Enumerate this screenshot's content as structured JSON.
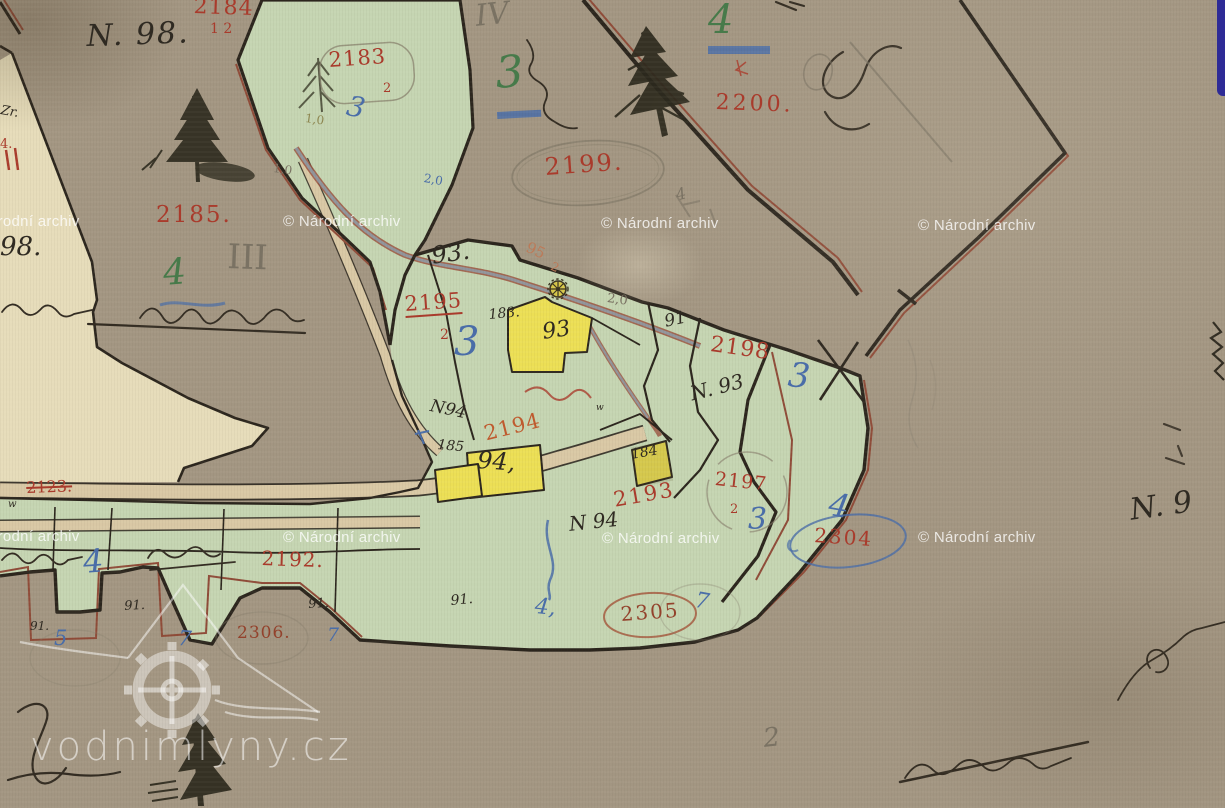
{
  "map": {
    "type": "historical-cadastral-map-scan",
    "colors": {
      "ink": "#2f2a22",
      "red": "#a93b2c",
      "orange": "#bf5a2e",
      "faded": "#bc7a58",
      "brownred": "#93422c",
      "green": "#477a4a",
      "blue": "#4a6da8",
      "pencil": "#7a7263",
      "olive": "#8d8650",
      "paper": "#a59884",
      "cream": "#e6dcba",
      "parcel_green": "#c5d5b2",
      "building_yellow": "#ecdf55",
      "road": "#d9c8a5",
      "boundary_black": "#2b251d",
      "boundary_redbrown": "#8f4b38"
    },
    "labels": [
      {
        "n": "label-n98",
        "t": "N. 98.",
        "x": 86,
        "y": 22,
        "s": 30,
        "c": "ink",
        "r": -2,
        "cls": "cur",
        "ls": 2
      },
      {
        "n": "label-98",
        "t": "98.",
        "x": 0,
        "y": 234,
        "s": 26,
        "c": "ink",
        "r": 0,
        "cls": "cur"
      },
      {
        "n": "label-zr",
        "t": "Zr.",
        "x": 2,
        "y": 104,
        "s": 13,
        "c": "ink",
        "r": 10,
        "cls": "cur"
      },
      {
        "n": "label-93-dot",
        "t": "93.",
        "x": 430,
        "y": 244,
        "s": 24,
        "c": "ink",
        "r": -8,
        "cls": "cur"
      },
      {
        "n": "label-183",
        "t": "183.",
        "x": 488,
        "y": 308,
        "s": 14,
        "c": "ink",
        "r": -5,
        "cls": "cur"
      },
      {
        "n": "label-93-house",
        "t": "93",
        "x": 541,
        "y": 322,
        "s": 22,
        "c": "ink",
        "r": -8,
        "cls": "cur"
      },
      {
        "n": "label-n94-upper",
        "t": "N94",
        "x": 432,
        "y": 398,
        "s": 17,
        "c": "ink",
        "r": 12,
        "cls": "cur"
      },
      {
        "n": "label-185",
        "t": "185",
        "x": 438,
        "y": 438,
        "s": 14,
        "c": "ink",
        "r": 5,
        "cls": "cur"
      },
      {
        "n": "label-94-house",
        "t": "94,",
        "x": 478,
        "y": 448,
        "s": 24,
        "c": "ink",
        "r": 4,
        "cls": "cur"
      },
      {
        "n": "label-184-house",
        "t": "184",
        "x": 630,
        "y": 448,
        "s": 14,
        "c": "ink",
        "r": -10,
        "cls": "cur"
      },
      {
        "n": "label-n94-lower",
        "t": "N 94",
        "x": 568,
        "y": 514,
        "s": 20,
        "c": "ink",
        "r": -6,
        "cls": "cur"
      },
      {
        "n": "label-91-upper",
        "t": "91",
        "x": 663,
        "y": 314,
        "s": 17,
        "c": "ink",
        "r": -12,
        "cls": "cur"
      },
      {
        "n": "label-n93",
        "t": "N. 93",
        "x": 688,
        "y": 384,
        "s": 20,
        "c": "ink",
        "r": -14,
        "cls": "cur"
      },
      {
        "n": "label-91-strip-a",
        "t": "91.",
        "x": 124,
        "y": 600,
        "s": 13,
        "c": "ink",
        "r": -3,
        "cls": "cur"
      },
      {
        "n": "label-91-strip-b",
        "t": "91.",
        "x": 308,
        "y": 598,
        "s": 13,
        "c": "ink",
        "r": -3,
        "cls": "cur"
      },
      {
        "n": "label-91-strip-c",
        "t": "91.",
        "x": 30,
        "y": 620,
        "s": 12,
        "c": "ink",
        "r": 0,
        "cls": "cur"
      },
      {
        "n": "label-91-strip-d",
        "t": "91.",
        "x": 450,
        "y": 594,
        "s": 14,
        "c": "ink",
        "r": -5,
        "cls": "cur"
      },
      {
        "n": "label-w-road",
        "t": "w",
        "x": 8,
        "y": 500,
        "s": 10,
        "c": "ink",
        "r": 0,
        "cls": "cur"
      },
      {
        "n": "label-w-mid",
        "t": "w",
        "x": 596,
        "y": 404,
        "s": 9,
        "c": "ink",
        "r": 0,
        "cls": "cur"
      },
      {
        "n": "label-n9-right",
        "t": "N. 9",
        "x": 1128,
        "y": 496,
        "s": 30,
        "c": "ink",
        "r": -8,
        "cls": "cur"
      },
      {
        "n": "parcel-2184",
        "t": "2184",
        "x": 194,
        "y": -4,
        "s": 22,
        "c": "red",
        "r": 2,
        "ls": 1
      },
      {
        "n": "parcel-2184-sub",
        "t": "1 2",
        "x": 210,
        "y": 22,
        "s": 14,
        "c": "red",
        "r": 0
      },
      {
        "n": "parcel-2183",
        "t": "2183",
        "x": 328,
        "y": 50,
        "s": 21,
        "c": "red",
        "r": -4,
        "ls": 1
      },
      {
        "n": "parcel-2183-sub",
        "t": "2",
        "x": 383,
        "y": 82,
        "s": 13,
        "c": "red",
        "r": 0
      },
      {
        "n": "parcel-2200",
        "t": "2200.",
        "x": 716,
        "y": 92,
        "s": 22,
        "c": "red",
        "r": 2,
        "ls": 3
      },
      {
        "n": "parcel-2199",
        "t": "2199.",
        "x": 544,
        "y": 155,
        "s": 24,
        "c": "red",
        "r": -4,
        "ls": 2
      },
      {
        "n": "parcel-2185",
        "t": "2185.",
        "x": 156,
        "y": 204,
        "s": 23,
        "c": "red",
        "r": 0,
        "ls": 2
      },
      {
        "n": "parcel-95-2",
        "t": "95",
        "x": 530,
        "y": 240,
        "s": 15,
        "c": "faded",
        "r": 25
      },
      {
        "n": "parcel-95-2-sub",
        "t": "2",
        "x": 554,
        "y": 260,
        "s": 12,
        "c": "faded",
        "r": 25
      },
      {
        "n": "parcel-2195",
        "t": "2195",
        "x": 404,
        "y": 294,
        "s": 21,
        "c": "red",
        "r": -4,
        "cls": "u",
        "ls": 1
      },
      {
        "n": "parcel-2195-sub",
        "t": "2",
        "x": 440,
        "y": 328,
        "s": 14,
        "c": "red",
        "r": 0
      },
      {
        "n": "parcel-2198",
        "t": "2198",
        "x": 712,
        "y": 334,
        "s": 22,
        "c": "red",
        "r": 8,
        "ls": 1
      },
      {
        "n": "parcel-2194",
        "t": "2194",
        "x": 482,
        "y": 424,
        "s": 21,
        "c": "orange",
        "r": -14,
        "ls": 1
      },
      {
        "n": "parcel-2193",
        "t": "2193",
        "x": 612,
        "y": 490,
        "s": 21,
        "c": "red",
        "r": -10,
        "ls": 2
      },
      {
        "n": "parcel-2197",
        "t": "2197",
        "x": 716,
        "y": 470,
        "s": 19,
        "c": "red",
        "r": 6,
        "ls": 1
      },
      {
        "n": "parcel-2197-sub",
        "t": "2",
        "x": 730,
        "y": 503,
        "s": 13,
        "c": "red",
        "r": 0
      },
      {
        "n": "parcel-2304",
        "t": "2304",
        "x": 815,
        "y": 525,
        "s": 20,
        "c": "red",
        "r": 4,
        "ls": 2
      },
      {
        "n": "parcel-2192",
        "t": "2192.",
        "x": 262,
        "y": 548,
        "s": 20,
        "c": "red",
        "r": 2,
        "ls": 1
      },
      {
        "n": "parcel-2306",
        "t": "2306.",
        "x": 237,
        "y": 625,
        "s": 17,
        "c": "brownred",
        "r": 0,
        "ls": 1
      },
      {
        "n": "parcel-2305",
        "t": "2305",
        "x": 620,
        "y": 604,
        "s": 20,
        "c": "brownred",
        "r": -4,
        "ls": 2
      },
      {
        "n": "parcel-2123",
        "t": "2123.",
        "x": 26,
        "y": 480,
        "s": 16,
        "c": "red",
        "r": -2,
        "cls": "st"
      },
      {
        "n": "mark-red-left",
        "t": "4.",
        "x": 0,
        "y": 138,
        "s": 13,
        "c": "red",
        "r": 0
      },
      {
        "n": "class-3-top",
        "t": "3",
        "x": 494,
        "y": 52,
        "s": 44,
        "c": "green",
        "r": -4,
        "cls": "cur"
      },
      {
        "n": "class-4-top",
        "t": "4",
        "x": 708,
        "y": 0,
        "s": 40,
        "c": "green",
        "r": 0,
        "cls": "cur"
      },
      {
        "n": "class-4-mid",
        "t": "4",
        "x": 162,
        "y": 256,
        "s": 36,
        "c": "green",
        "r": -4,
        "cls": "cur"
      },
      {
        "n": "class-3-band",
        "t": "3",
        "x": 350,
        "y": 92,
        "s": 28,
        "c": "blue",
        "r": 12,
        "cls": "cur"
      },
      {
        "n": "class-3-central",
        "t": "3",
        "x": 454,
        "y": 322,
        "s": 40,
        "c": "blue",
        "r": 0,
        "cls": "cur"
      },
      {
        "n": "class-3-east",
        "t": "3",
        "x": 790,
        "y": 358,
        "s": 34,
        "c": "blue",
        "r": 6,
        "cls": "cur"
      },
      {
        "n": "class-3-south",
        "t": "3",
        "x": 748,
        "y": 505,
        "s": 30,
        "c": "blue",
        "r": 0,
        "cls": "cur"
      },
      {
        "n": "class-4-east",
        "t": "4",
        "x": 832,
        "y": 488,
        "s": 32,
        "c": "blue",
        "r": 10,
        "cls": "cur"
      },
      {
        "n": "class-4-strip",
        "t": "4",
        "x": 82,
        "y": 546,
        "s": 32,
        "c": "blue",
        "r": -4,
        "cls": "cur"
      },
      {
        "n": "class-4-mid-strip",
        "t": "4,",
        "x": 536,
        "y": 596,
        "s": 22,
        "c": "blue",
        "r": 6,
        "cls": "cur"
      },
      {
        "n": "mark-5-strip",
        "t": "5",
        "x": 54,
        "y": 628,
        "s": 21,
        "c": "blue",
        "r": 0,
        "cls": "cur"
      },
      {
        "n": "mark-7-strip-a",
        "t": "7",
        "x": 179,
        "y": 628,
        "s": 21,
        "c": "blue",
        "r": 5,
        "cls": "cur"
      },
      {
        "n": "mark-7-strip-b",
        "t": "7",
        "x": 327,
        "y": 626,
        "s": 19,
        "c": "blue",
        "r": 0,
        "cls": "cur"
      },
      {
        "n": "mark-7-strip-c",
        "t": "7",
        "x": 697,
        "y": 590,
        "s": 22,
        "c": "blue",
        "r": 10,
        "cls": "cur"
      },
      {
        "n": "mark-20-band",
        "t": "2,0",
        "x": 425,
        "y": 172,
        "s": 12,
        "c": "blue",
        "r": 10
      },
      {
        "n": "roman-iv",
        "t": "IV",
        "x": 474,
        "y": 2,
        "s": 30,
        "c": "pencil",
        "r": -6,
        "cls": "cur"
      },
      {
        "n": "roman-iii",
        "t": "III",
        "x": 228,
        "y": 240,
        "s": 34,
        "c": "pencil",
        "r": 2
      },
      {
        "n": "mark-2-bottom",
        "t": "2",
        "x": 762,
        "y": 726,
        "s": 26,
        "c": "pencil",
        "r": -6,
        "cls": "cur"
      },
      {
        "n": "mark-10-a",
        "t": "1,0",
        "x": 306,
        "y": 112,
        "s": 12,
        "c": "olive",
        "r": 8
      },
      {
        "n": "mark-10-b",
        "t": "1,0",
        "x": 274,
        "y": 162,
        "s": 12,
        "c": "pencil",
        "r": 8
      },
      {
        "n": "mark-20-mid",
        "t": "2,0",
        "x": 608,
        "y": 292,
        "s": 13,
        "c": "pencil",
        "r": 8
      },
      {
        "n": "mark-4-pencil",
        "t": "4",
        "x": 674,
        "y": 188,
        "s": 16,
        "c": "pencil",
        "r": -15,
        "cls": "cur"
      }
    ]
  },
  "watermarks": {
    "archive_text": "© Národní archiv",
    "archive_positions": [
      {
        "x": -38,
        "y": 213
      },
      {
        "x": 283,
        "y": 213
      },
      {
        "x": 601,
        "y": 215
      },
      {
        "x": 918,
        "y": 217
      },
      {
        "x": -38,
        "y": 528
      },
      {
        "x": 283,
        "y": 529
      },
      {
        "x": 602,
        "y": 530
      },
      {
        "x": 918,
        "y": 529
      }
    ],
    "logo_text": "vodnimlyny.cz"
  },
  "ui": {
    "corner_fragment_color": "#2e2b96"
  }
}
